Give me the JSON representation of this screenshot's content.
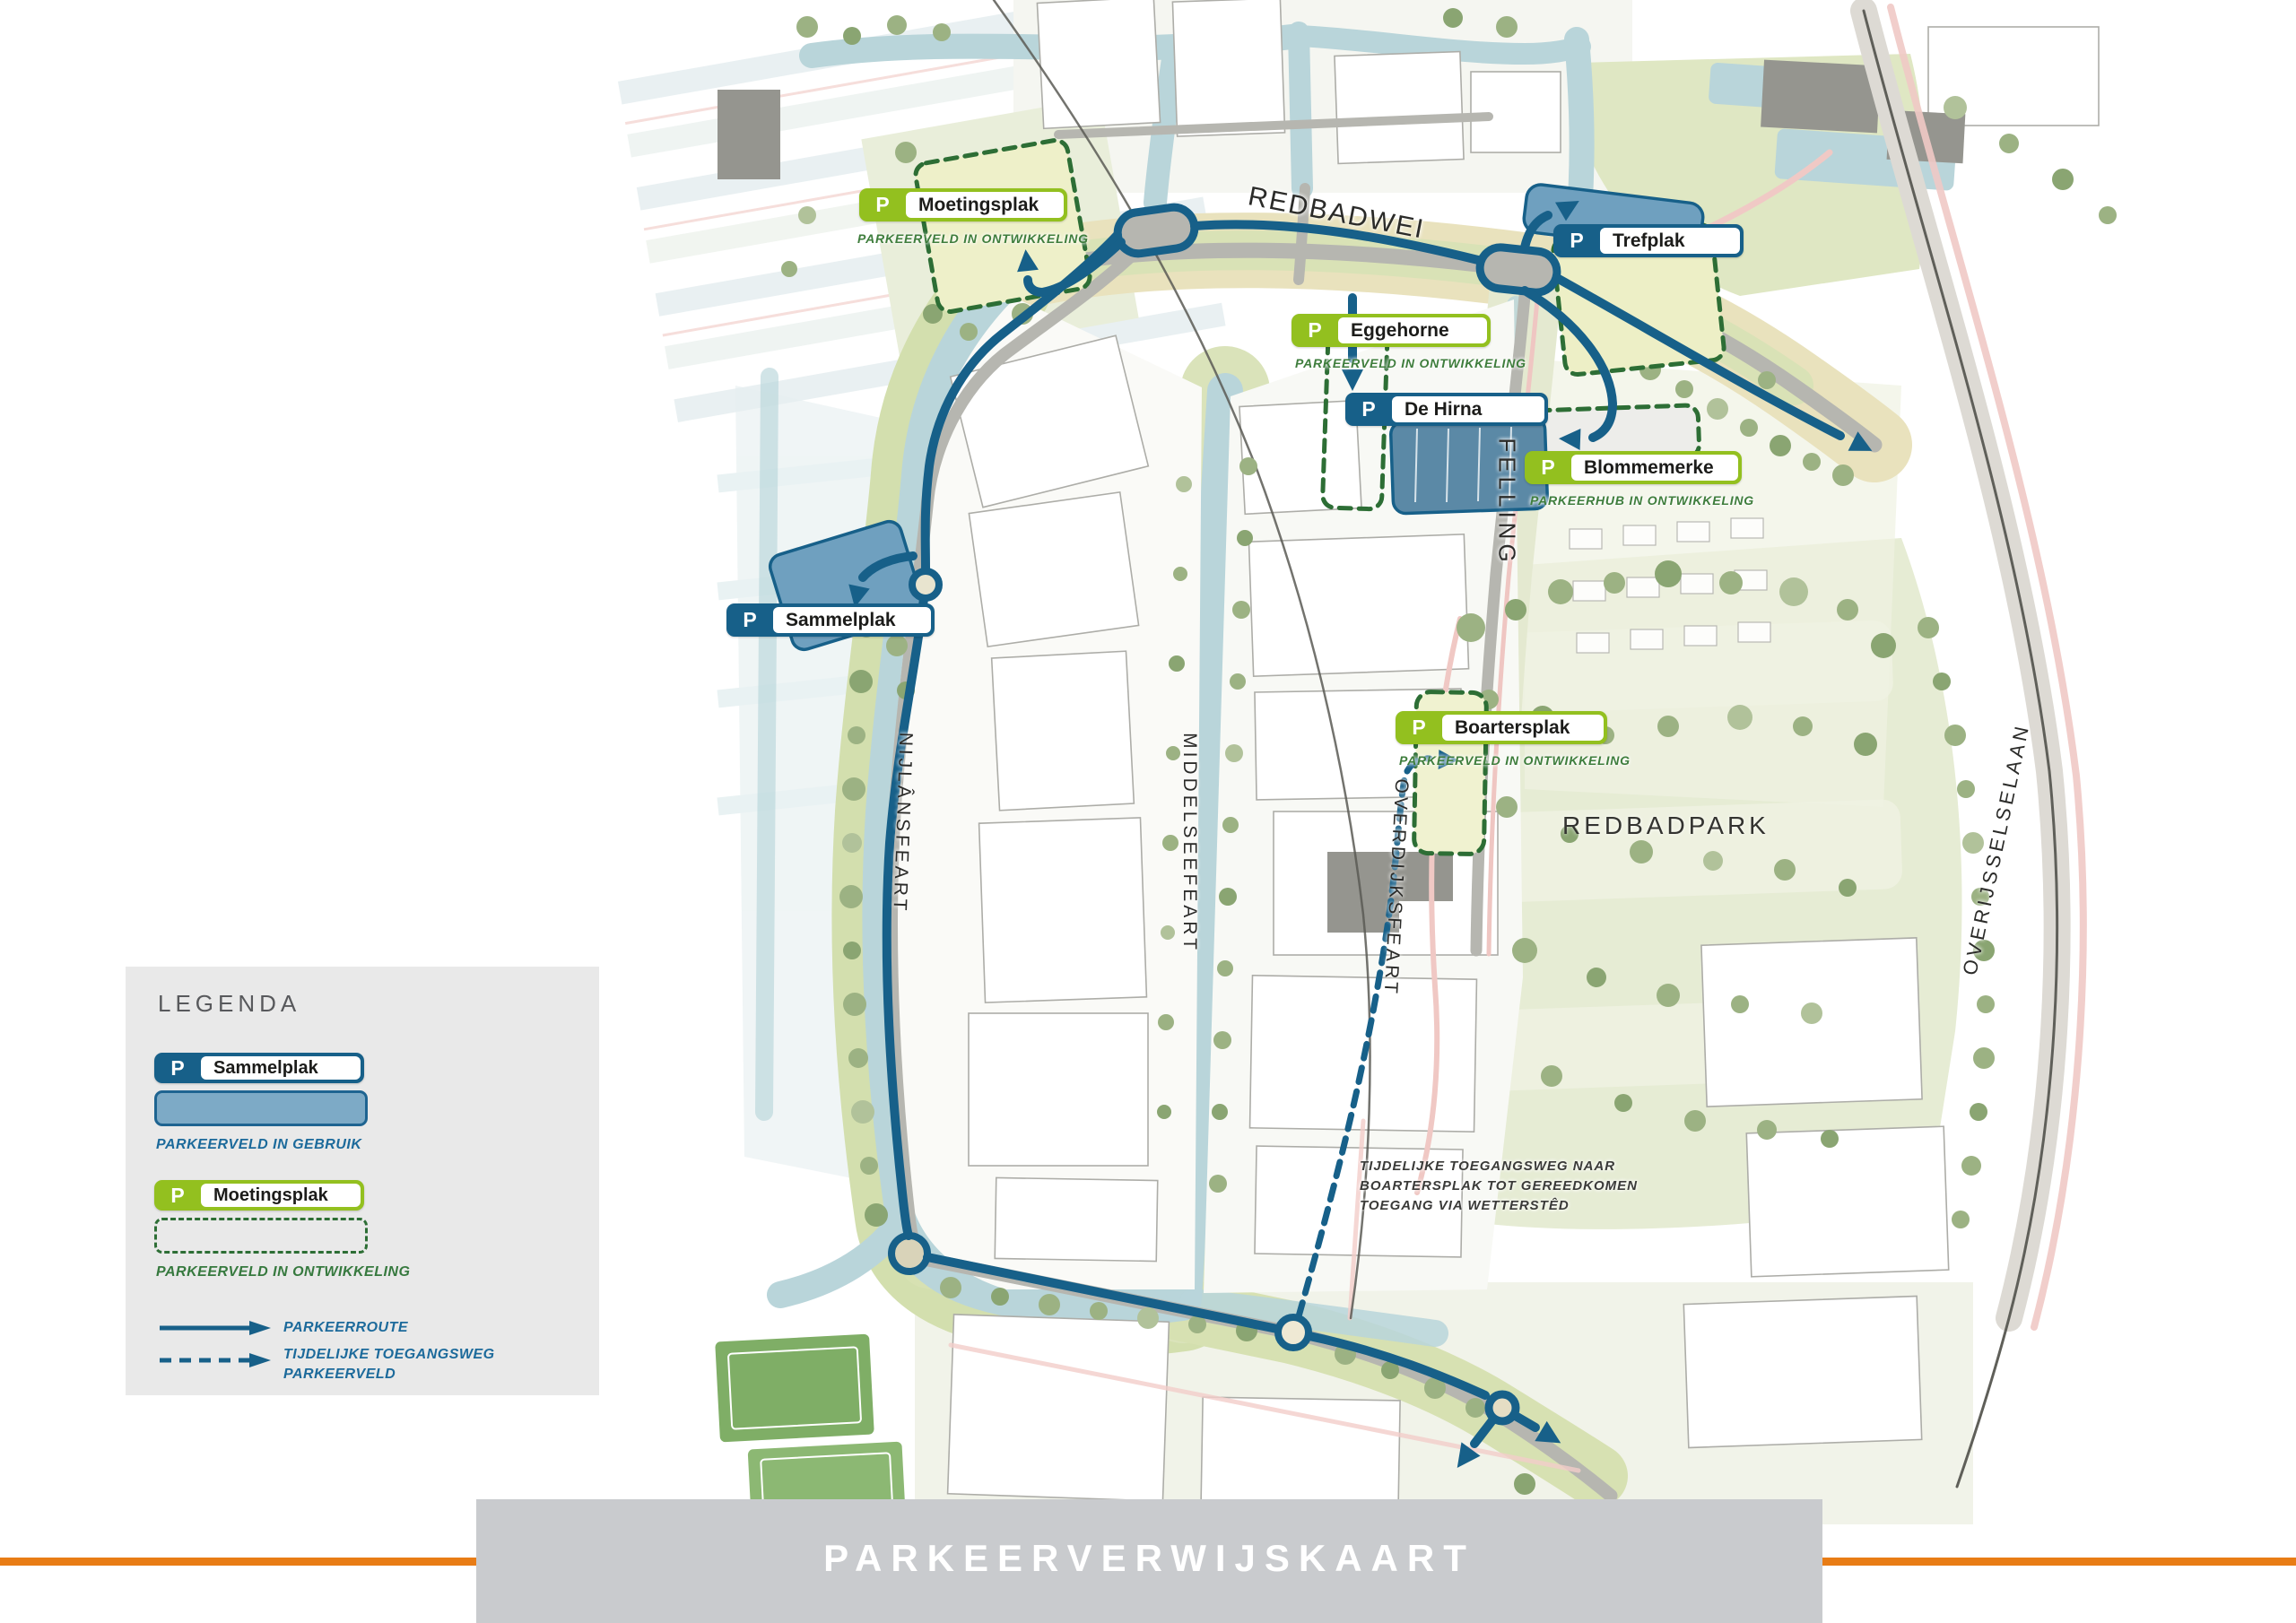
{
  "banner": {
    "title": "PARKEERVERWIJSKAART"
  },
  "legend": {
    "heading": "LEGENDA",
    "in_use_example": {
      "badge": "P",
      "label": "Sammelplak"
    },
    "in_use_caption": "PARKEERVELD IN GEBRUIK",
    "in_development_example": {
      "badge": "P",
      "label": "Moetingsplak"
    },
    "in_development_caption": "PARKEERVELD IN ONTWIKKELING",
    "route_label": "PARKEERROUTE",
    "temp_route_label": [
      "TIJDELIJKE TOEGANGSWEG",
      "PARKEERVELD"
    ]
  },
  "map": {
    "streets": {
      "redbadwei": "REDBADWEI",
      "felling": "FELLING",
      "nijlansfeart": "NIJLÂNSFEART",
      "middelseefeart": "MIDDELSEEFEART",
      "overdijksfeart": "OVERDIJKSFEART",
      "overijsselselaan": "OVERIJSSELSELAAN"
    },
    "park_label": "REDBADPARK",
    "parkings": [
      {
        "badge": "P",
        "label": "Moetingsplak",
        "caption": "PARKEERVELD IN ONTWIKKELING",
        "status": "in_development"
      },
      {
        "badge": "P",
        "label": "Trefplak",
        "caption": "",
        "status": "in_use"
      },
      {
        "badge": "P",
        "label": "Eggehorne",
        "caption": "PARKEERVELD IN ONTWIKKELING",
        "status": "in_development"
      },
      {
        "badge": "P",
        "label": "De Hirna",
        "caption": "",
        "status": "in_use"
      },
      {
        "badge": "P",
        "label": "Blommemerke",
        "caption": "PARKEERHUB IN ONTWIKKELING",
        "status": "in_development"
      },
      {
        "badge": "P",
        "label": "Sammelplak",
        "caption": "",
        "status": "in_use"
      },
      {
        "badge": "P",
        "label": "Boartersplak",
        "caption": "PARKEERVELD IN ONTWIKKELING",
        "status": "in_development"
      }
    ],
    "note": {
      "line1": "TIJDELIJKE TOEGANGSWEG NAAR",
      "line2": "BOARTERSPLAK TOT GEREEDKOMEN",
      "line3": "TOEGANG VIA WETTERSTÊD"
    },
    "colors": {
      "route_blue": "#176089",
      "parking_in_use_fill": "#6fa0bf",
      "development_dash_green": "#2d6e35",
      "badge_green": "#93c01f",
      "badge_blue": "#176089",
      "caption_green": "#3e7d3c",
      "caption_blue": "#1c6a9b",
      "water": "#b9d5da",
      "banner_gray": "#c9cbce",
      "accent_orange": "#e87c15"
    }
  }
}
